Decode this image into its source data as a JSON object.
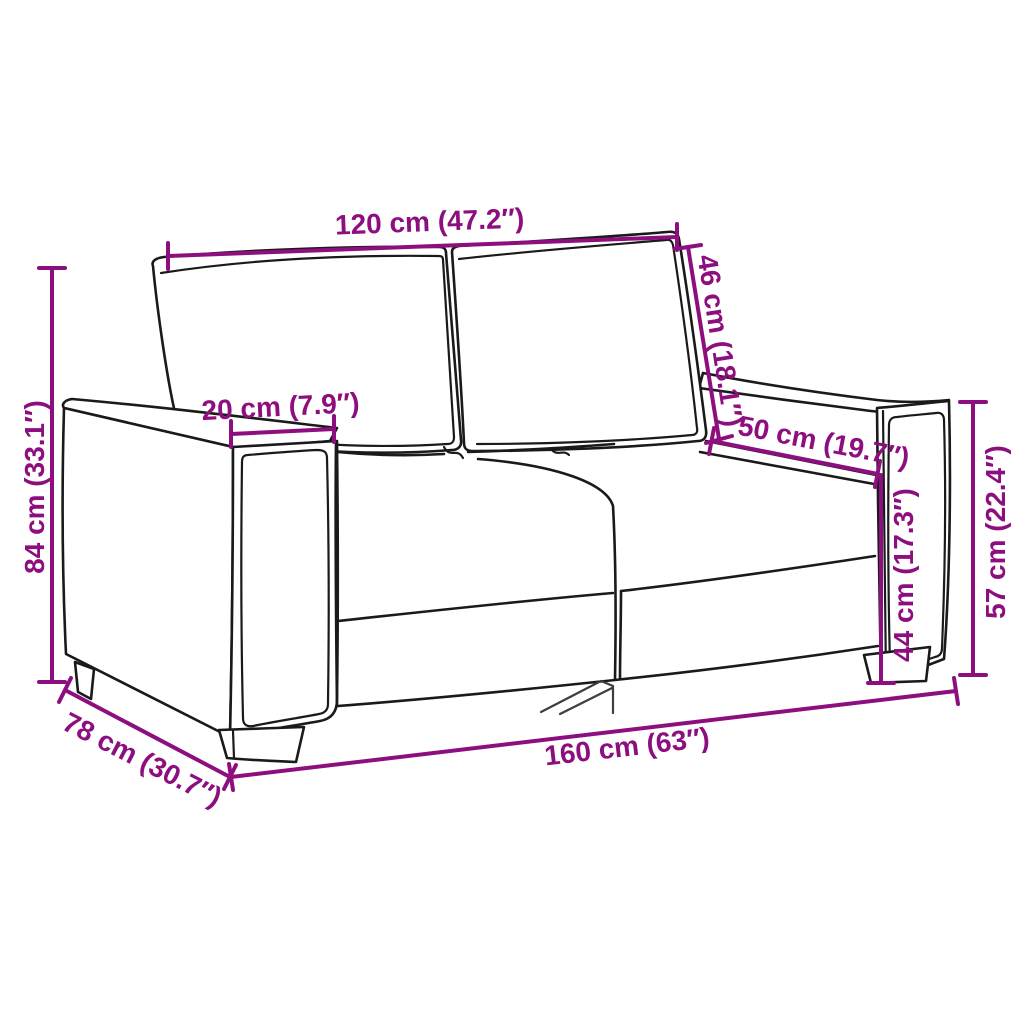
{
  "meta": {
    "title": "Sofa dimension diagram",
    "subject": "2-seater sofa line drawing with measurement annotations",
    "units": "centimetres with inches in parentheses"
  },
  "colors": {
    "dimension_accent": "#8D0F7F",
    "outline": "#1a1a1a",
    "background": "#ffffff"
  },
  "dimensions": {
    "back_width": {
      "label": "120 cm (47.2″)",
      "cm": 120,
      "inches": 47.2
    },
    "backrest_height": {
      "label": "46 cm (18.1″)",
      "cm": 46,
      "inches": 18.1
    },
    "armrest_width": {
      "label": "20 cm (7.9″)",
      "cm": 20,
      "inches": 7.9
    },
    "seat_depth": {
      "label": "50 cm (19.7″)",
      "cm": 50,
      "inches": 19.7
    },
    "overall_height": {
      "label": "84 cm (33.1″)",
      "cm": 84,
      "inches": 33.1
    },
    "seat_height": {
      "label": "44 cm (17.3″)",
      "cm": 44,
      "inches": 17.3
    },
    "arm_height": {
      "label": "57 cm (22.4″)",
      "cm": 57,
      "inches": 22.4
    },
    "overall_depth": {
      "label": "78 cm (30.7″)",
      "cm": 78,
      "inches": 30.7
    },
    "overall_width": {
      "label": "160 cm (63″)",
      "cm": 160,
      "inches": 63
    }
  }
}
